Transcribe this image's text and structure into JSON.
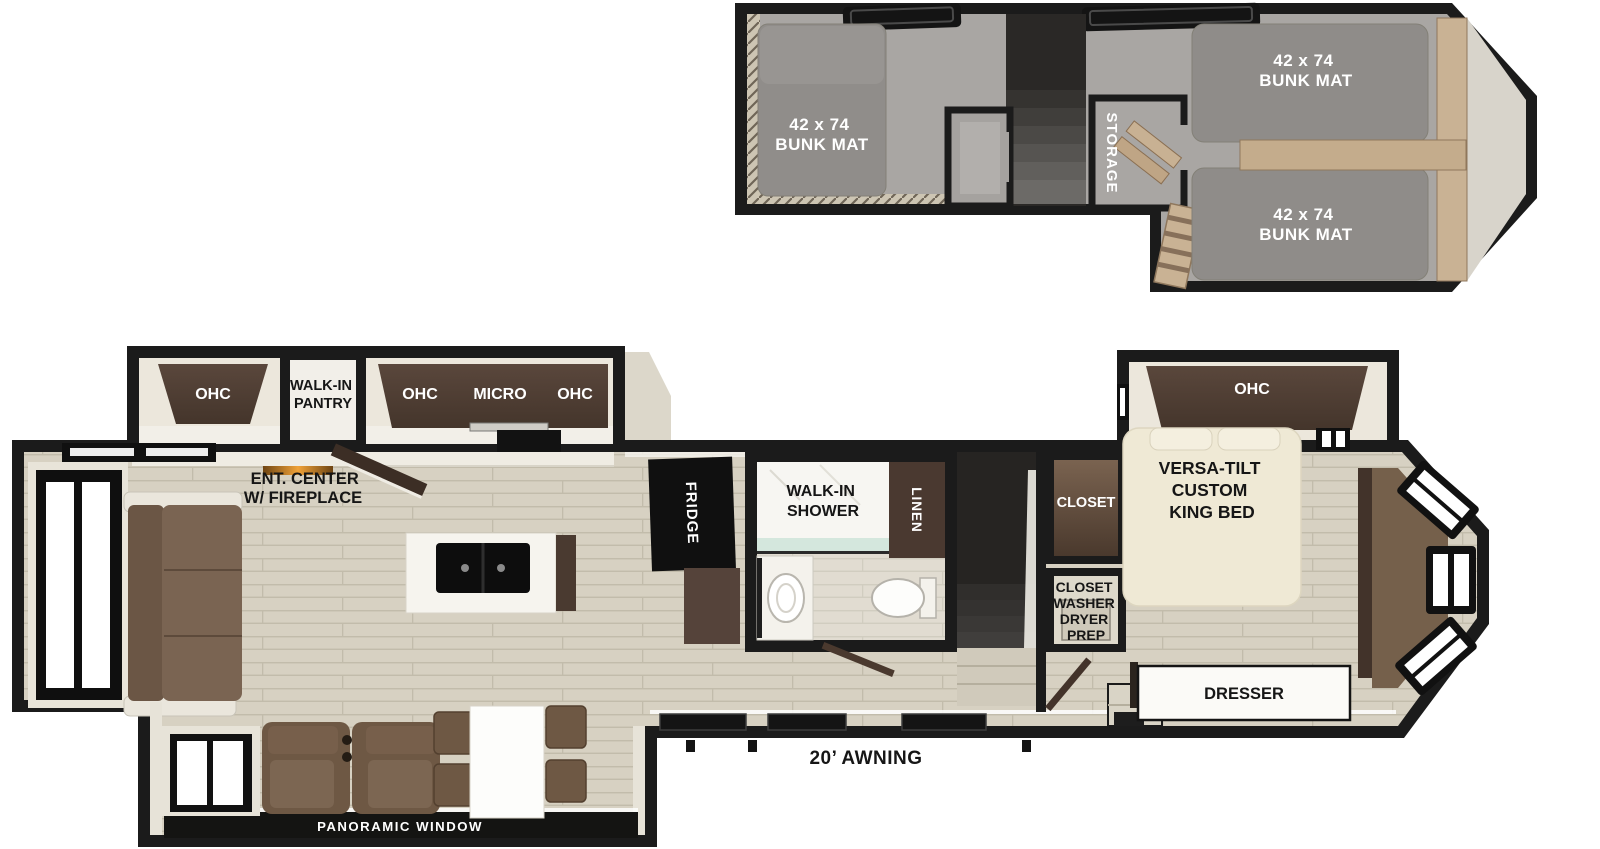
{
  "floorplan": {
    "loft": {
      "bunks": [
        {
          "size": "42 x 74",
          "name": "BUNK MAT"
        },
        {
          "size": "42 x 74",
          "name": "BUNK MAT"
        },
        {
          "size": "42 x 74",
          "name": "BUNK MAT"
        }
      ],
      "storage": "STORAGE"
    },
    "main": {
      "ohc_rear": "OHC",
      "pantry": [
        "WALK-IN",
        "PANTRY"
      ],
      "ohc_kitchen_left": "OHC",
      "micro": "MICRO",
      "ohc_kitchen_right": "OHC",
      "ent_center": [
        "ENT. CENTER",
        "W/ FIREPLACE"
      ],
      "fridge": "FRIDGE",
      "shower": [
        "WALK-IN",
        "SHOWER"
      ],
      "linen": "LINEN",
      "closet": "CLOSET",
      "washer_dryer": [
        "CLOSET",
        "WASHER",
        "DRYER",
        "PREP"
      ],
      "bedroom_ohc": "OHC",
      "king_bed": [
        "VERSA-TILT",
        "CUSTOM",
        "KING BED"
      ],
      "dresser": "DRESSER"
    },
    "exterior": {
      "awning": "20’ AWNING",
      "panoramic_window": "PANORAMIC WINDOW"
    },
    "palette": {
      "walls": "#1b1b1b",
      "wood_floor": "#d7d1c2",
      "loft_carpet": "#a9a6a3",
      "cabinet_brown": "#4f3e34",
      "sofa_brown": "#6f5945",
      "bed_cream": "#efe9d5",
      "flame_orange": "#f0a238",
      "shower_glass": "#cfe6da"
    }
  }
}
